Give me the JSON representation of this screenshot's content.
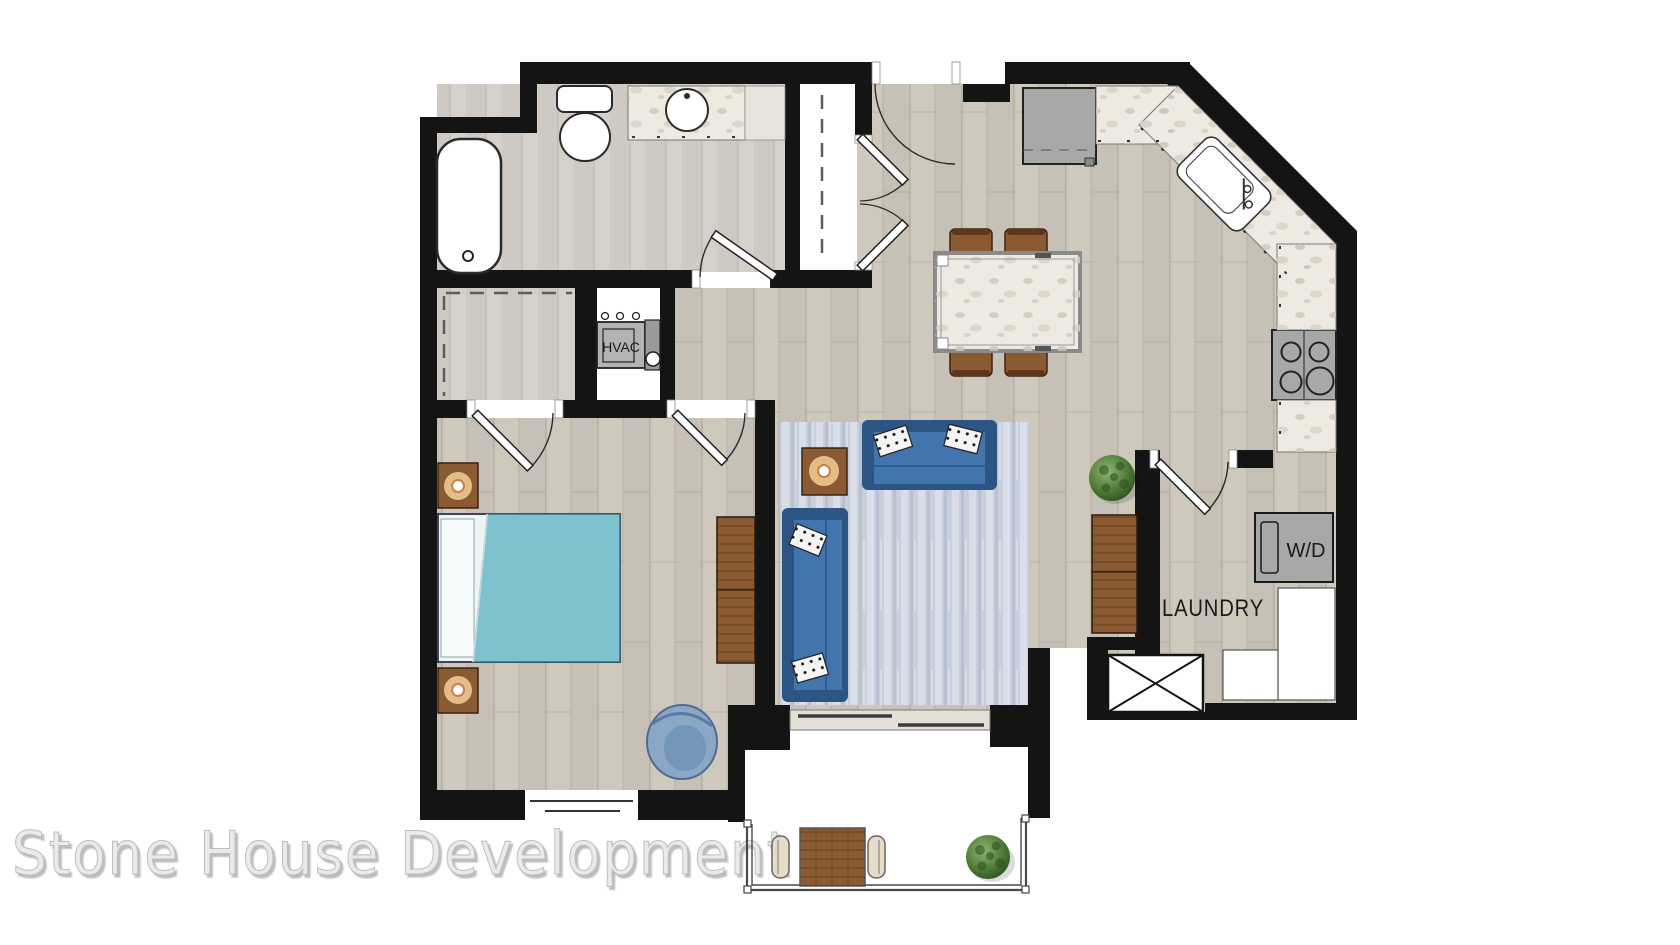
{
  "plan": {
    "labels": {
      "hvac": "HVAC",
      "washer_dryer": "W/D",
      "laundry": "LAUNDRY"
    },
    "watermark": "Stone House Development",
    "colors": {
      "wall": "#141414",
      "floor_wood": "#cfc8bd",
      "floor_tile": "#d5d0c9",
      "closet_floor": "#ffffff",
      "rug": "#c8cfdd",
      "sofa": "#4274ad",
      "sofa_frame": "#2c5583",
      "bed_blanket": "#7fc2cf",
      "bed_sheet": "#f2f7f7",
      "wood": "#8a5a33",
      "appliance": "#a8a8a8",
      "counter": "#eeeae2",
      "fixture": "#ffffff",
      "plant": "#4e7a38",
      "railing": "#4a4a4a",
      "watermark": "#eaeaea"
    }
  }
}
